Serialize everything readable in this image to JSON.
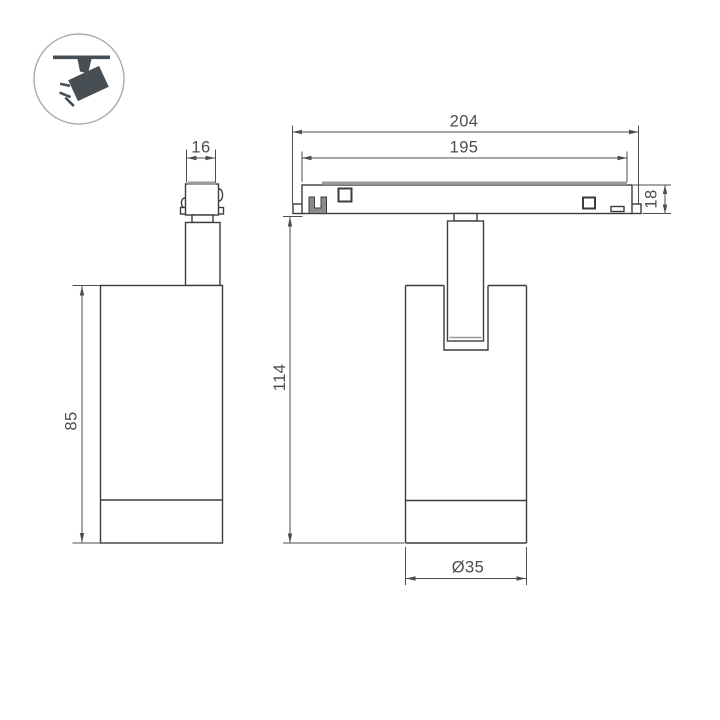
{
  "icon": {
    "name": "ceiling-track-spotlight-pictogram",
    "color": "#484f54",
    "ring_color": "#acacac"
  },
  "drawing": {
    "type": "technical-dimension-drawing",
    "object_color": "#3a3d40",
    "dim_color": "#4d4d4d",
    "plate_color": "#9a9a9a",
    "background": "#ffffff",
    "views": {
      "front": {
        "dimensions": {
          "adapter_width": "16",
          "body_height": "85"
        }
      },
      "side": {
        "dimensions": {
          "overall_length": "204",
          "plate_length": "195",
          "plate_height": "18",
          "fixture_height": "114",
          "body_diameter": "Ø35"
        }
      }
    }
  }
}
